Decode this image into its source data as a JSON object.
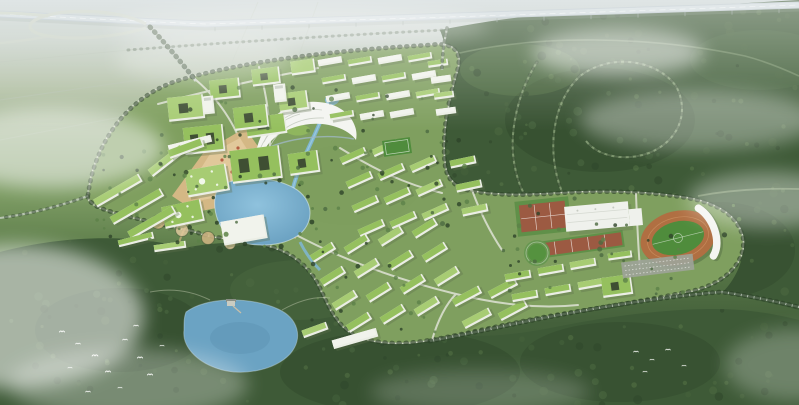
{
  "scene": {
    "type": "aerial-architectural-rendering",
    "subject": "Bird's-eye rendering of an eco campus master plan surrounded by forest",
    "landmarks": {
      "highway": "elevated expressway crossing the top",
      "interchange": "highway interchange with loop ramp (top-left)",
      "campus": "campus of green-roofed buildings inside a tree-lined ring road",
      "arc_building": "curved white-roof landmark building (library)",
      "plaza": "tan paved entrance plaza",
      "central_lake": "central campus lake with canal",
      "forest_lake": "lake in the forest (lower-left) with small pavilion",
      "stadium": "athletics stadium with oval running track and grandstand canopy",
      "gymnasium": "large white flat-roof gymnasium",
      "courts": "red tennis and basketball courts",
      "round_lawn": "circular lawn beside the courts",
      "parking": "parking lot south of the stadium",
      "dormitories": "staggered rows of green-roofed dormitory slabs",
      "forest": "dense woodland filling the foreground and right side",
      "forest_roads": "curved tree-lined loop roads through the forest",
      "mist": "low white mist and cloud patches",
      "birds": "flocks of white birds over the forest"
    },
    "counts": {
      "birds_lower_left": 12,
      "birds_right": 5
    }
  },
  "colors": {
    "haze_top": "#c8d2d3",
    "field_line": "#b8c3b4",
    "campus_grass": "#7f9f5f",
    "campus_grass_light": "#93b36c",
    "forest_dark": "#3e5a37",
    "forest_deep": "#2f472b",
    "forest_mid": "#4c6a41",
    "canopy_light": "#6c8f55",
    "tree_dark": "#2e4429",
    "tree_light": "#5d8148",
    "roof_green": "#95c05e",
    "roof_green_light": "#a7cc73",
    "roof_dark": "#35422f",
    "building_white": "#ebeee5",
    "building_shadow": "#5f6f4e",
    "road_light": "#dfe2d5",
    "road_rural": "#c9d2c6",
    "highway_deck": "#bac6cb",
    "highway_top": "#cfd9dc",
    "forest_road": "#93ab80",
    "plaza_tan": "#d9b987",
    "plaza_light": "#e6cda1",
    "plaza_red": "#b0543a",
    "water_lake": "#7fb6d4",
    "water_light": "#a8d4e8",
    "water_deep": "#5e93b4",
    "water_forest_lake": "#6ba3c3",
    "track_orange": "#b06f42",
    "pitch_green": "#4f8c3c",
    "court_red": "#9c5a42",
    "court_green": "#5f8f48",
    "gym_white": "#eff1ec",
    "stand_white": "#f4f5f1",
    "parking_grey": "#9da398",
    "cloud_white": "#ffffff",
    "bird_white": "#f6f8f5"
  }
}
